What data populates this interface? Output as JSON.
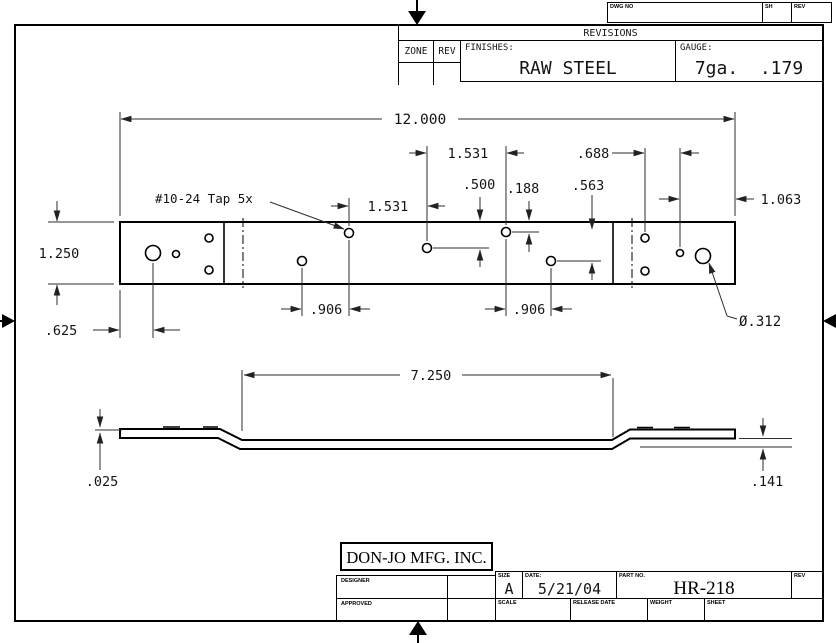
{
  "header": {
    "dwg_no": "DWG NO",
    "sh": "SH",
    "rev": "REV"
  },
  "revisions": {
    "title": "REVISIONS",
    "zone": "ZONE",
    "rev": "REV",
    "finishes_label": "FINISHES:",
    "finishes_value": "RAW STEEL",
    "gauge_label": "GAUGE:",
    "gauge_value": "7ga.  .179"
  },
  "dims": {
    "overall": "12.000",
    "tap_note": "#10-24 Tap 5x",
    "pitch_a": "1.531",
    "pitch_b": "1.531",
    "from_top_500": ".500",
    "from_top_188": ".188",
    "step_563": ".563",
    "pitch_688": ".688",
    "end_1063": "1.063",
    "bar_height": "1.250",
    "end_625": ".625",
    "pitch_left_906": ".906",
    "pitch_right_906": ".906",
    "hole_dia": "Ø.312",
    "flat_length": "7.250",
    "offset_left": ".025",
    "offset_right": ".141"
  },
  "title_block": {
    "company": "DON-JO MFG. INC.",
    "designer_label": "DESIGNER",
    "approved_label": "APPROVED",
    "size_label": "SIZE",
    "size_value": "A",
    "date_label": "DATE:",
    "date_value": "5/21/04",
    "part_label": "PART NO.",
    "part_value": "HR-218",
    "rev_label": "REV",
    "scale_label": "SCALE",
    "release_label": "RELEASE DATE",
    "weight_label": "WEIGHT",
    "sheet_label": "SHEET"
  },
  "colors": {
    "line": "#000000",
    "dim_line": "#2e2e2e",
    "text": "#141414"
  }
}
